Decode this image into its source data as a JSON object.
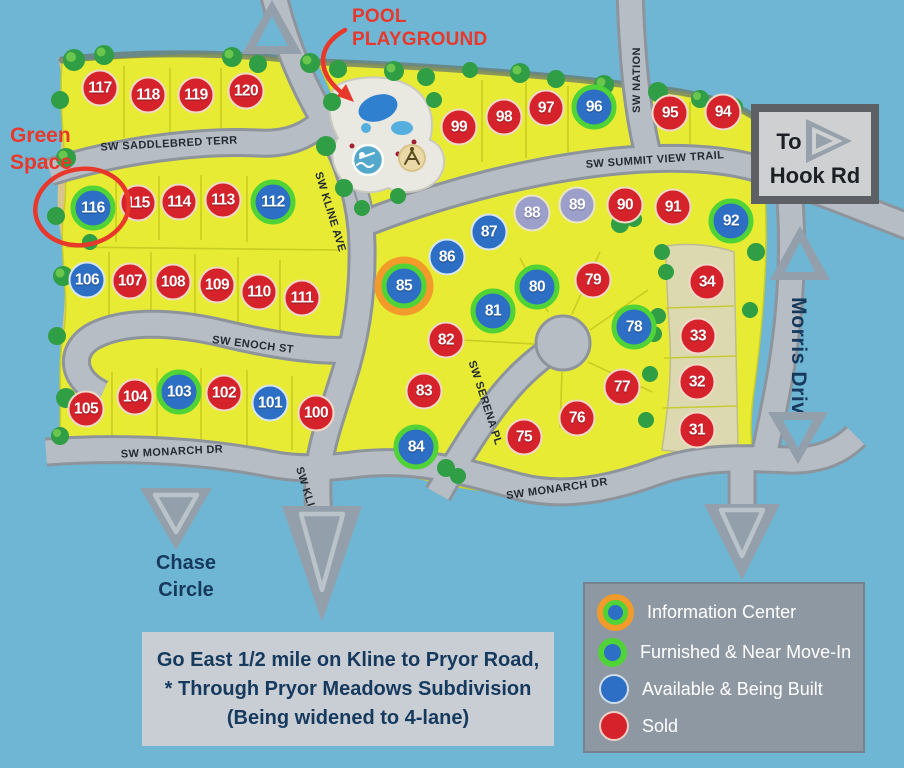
{
  "colors": {
    "sky": "#6fb6d4",
    "land": "#e7eb33",
    "land_line": "#c8ce25",
    "street": "#b7bdc4",
    "street_edge": "#8d949c",
    "sand": "#d9c48e",
    "strip": "#dcd9b0",
    "tree": "#2f9e44",
    "tree_light": "#76cc4f",
    "sold": "#d6232b",
    "available": "#2d6fc4",
    "furnished_ring": "#4fd337",
    "info_ring": "#f29b2a",
    "other": "#9b9fc9",
    "navy": "#16395e",
    "red_annot": "#e8382c",
    "arrow": "#93a0ab",
    "arrow_inner": "#bac3ca",
    "legend_bg": "#8e98a2",
    "panel_bg": "#c9ced4",
    "sign_border": "#5d6065",
    "sign_bg": "#cfd0d2"
  },
  "streets": {
    "saddlebred": "SW SADDLEBRED TERR",
    "kline": "SW KLINE AVE",
    "kline_south": "SW KLINE AVE",
    "nation": "SW NATION",
    "summit": "SW SUMMIT VIEW TRAIL",
    "enoch": "SW ENOCH ST",
    "monarch_left": "SW MONARCH DR",
    "monarch_right": "SW MONARCH DR",
    "serena": "SW SERENA PL",
    "morris": "Morris Drive"
  },
  "annotations": {
    "pool": [
      "POOL",
      "PLAYGROUND"
    ],
    "green_space": [
      "Green",
      "Space"
    ],
    "chase": [
      "Chase",
      "Circle"
    ],
    "hook": [
      "To",
      "Hook Rd"
    ],
    "directions": [
      "Go East 1/2 mile on Kline to Pryor Road,",
      "* Through Pryor Meadows Subdivision",
      "(Being widened to 4-lane)"
    ]
  },
  "legend": {
    "items": [
      {
        "label": "Information Center",
        "status": "info"
      },
      {
        "label": "Furnished & Near Move-In",
        "status": "furnished"
      },
      {
        "label": "Available & Being Built",
        "status": "available"
      },
      {
        "label": "Sold",
        "status": "sold"
      }
    ]
  },
  "lots": [
    {
      "n": 117,
      "s": "sold",
      "x": 100,
      "y": 88
    },
    {
      "n": 118,
      "s": "sold",
      "x": 148,
      "y": 95
    },
    {
      "n": 119,
      "s": "sold",
      "x": 196,
      "y": 95
    },
    {
      "n": 120,
      "s": "sold",
      "x": 246,
      "y": 91
    },
    {
      "n": 116,
      "s": "furnished",
      "x": 93,
      "y": 208
    },
    {
      "n": 115,
      "s": "sold",
      "x": 138,
      "y": 203
    },
    {
      "n": 114,
      "s": "sold",
      "x": 179,
      "y": 202
    },
    {
      "n": 113,
      "s": "sold",
      "x": 223,
      "y": 200
    },
    {
      "n": 112,
      "s": "furnished",
      "x": 273,
      "y": 202
    },
    {
      "n": 106,
      "s": "available",
      "x": 87,
      "y": 280
    },
    {
      "n": 107,
      "s": "sold",
      "x": 130,
      "y": 281
    },
    {
      "n": 108,
      "s": "sold",
      "x": 173,
      "y": 282
    },
    {
      "n": 109,
      "s": "sold",
      "x": 217,
      "y": 285
    },
    {
      "n": 110,
      "s": "sold",
      "x": 259,
      "y": 292
    },
    {
      "n": 111,
      "s": "sold",
      "x": 302,
      "y": 298
    },
    {
      "n": 105,
      "s": "sold",
      "x": 86,
      "y": 409
    },
    {
      "n": 104,
      "s": "sold",
      "x": 135,
      "y": 397
    },
    {
      "n": 103,
      "s": "furnished",
      "x": 179,
      "y": 392
    },
    {
      "n": 102,
      "s": "sold",
      "x": 224,
      "y": 393
    },
    {
      "n": 101,
      "s": "available",
      "x": 270,
      "y": 403
    },
    {
      "n": 100,
      "s": "sold",
      "x": 316,
      "y": 413
    },
    {
      "n": 99,
      "s": "sold",
      "x": 459,
      "y": 127
    },
    {
      "n": 98,
      "s": "sold",
      "x": 504,
      "y": 117
    },
    {
      "n": 97,
      "s": "sold",
      "x": 546,
      "y": 108
    },
    {
      "n": 96,
      "s": "furnished",
      "x": 594,
      "y": 107
    },
    {
      "n": 95,
      "s": "sold",
      "x": 670,
      "y": 113
    },
    {
      "n": 94,
      "s": "sold",
      "x": 723,
      "y": 112
    },
    {
      "n": 88,
      "s": "other",
      "x": 532,
      "y": 213
    },
    {
      "n": 89,
      "s": "other",
      "x": 577,
      "y": 205
    },
    {
      "n": 90,
      "s": "sold",
      "x": 625,
      "y": 205
    },
    {
      "n": 91,
      "s": "sold",
      "x": 673,
      "y": 207
    },
    {
      "n": 92,
      "s": "furnished",
      "x": 731,
      "y": 221
    },
    {
      "n": 87,
      "s": "available",
      "x": 489,
      "y": 232
    },
    {
      "n": 86,
      "s": "available",
      "x": 447,
      "y": 257
    },
    {
      "n": 85,
      "s": "info",
      "x": 404,
      "y": 286
    },
    {
      "n": 80,
      "s": "furnished",
      "x": 537,
      "y": 287
    },
    {
      "n": 79,
      "s": "sold",
      "x": 593,
      "y": 280
    },
    {
      "n": 81,
      "s": "furnished",
      "x": 493,
      "y": 311
    },
    {
      "n": 82,
      "s": "sold",
      "x": 446,
      "y": 340
    },
    {
      "n": 78,
      "s": "furnished",
      "x": 634,
      "y": 327
    },
    {
      "n": 83,
      "s": "sold",
      "x": 424,
      "y": 391
    },
    {
      "n": 77,
      "s": "sold",
      "x": 622,
      "y": 387
    },
    {
      "n": 84,
      "s": "furnished",
      "x": 416,
      "y": 447
    },
    {
      "n": 75,
      "s": "sold",
      "x": 524,
      "y": 437
    },
    {
      "n": 76,
      "s": "sold",
      "x": 577,
      "y": 418
    },
    {
      "n": 34,
      "s": "sold",
      "x": 707,
      "y": 282
    },
    {
      "n": 33,
      "s": "sold",
      "x": 698,
      "y": 336
    },
    {
      "n": 32,
      "s": "sold",
      "x": 697,
      "y": 382
    },
    {
      "n": 31,
      "s": "sold",
      "x": 697,
      "y": 430
    }
  ]
}
